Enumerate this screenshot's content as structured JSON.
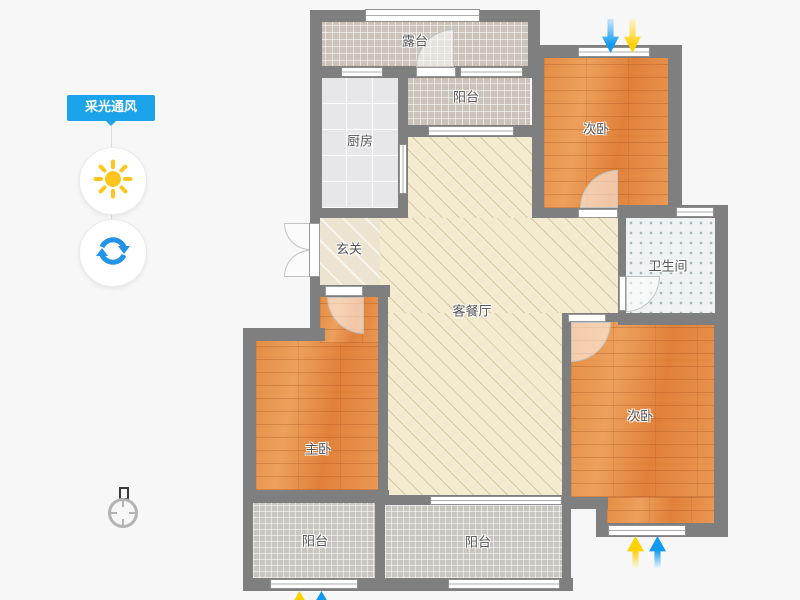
{
  "panel": {
    "badge_label": "采光通风",
    "accent_color": "#1aa3e8",
    "sun_button": {
      "icon": "sun-icon",
      "color": "#ffc41d"
    },
    "rotate_button": {
      "icon": "rotate-icon",
      "color": "#2293e6"
    }
  },
  "floorplan": {
    "wall_color": "#7f7f7f",
    "rooms": [
      {
        "id": "terrace",
        "label": "露台"
      },
      {
        "id": "balcony-top",
        "label": "阳台"
      },
      {
        "id": "kitchen",
        "label": "厨房"
      },
      {
        "id": "bedroom-top",
        "label": "次卧"
      },
      {
        "id": "foyer",
        "label": "玄关"
      },
      {
        "id": "bathroom",
        "label": "卫生间"
      },
      {
        "id": "living-dining",
        "label": "客餐厅"
      },
      {
        "id": "master-bedroom",
        "label": "主卧"
      },
      {
        "id": "bedroom-bottom",
        "label": "次卧"
      },
      {
        "id": "balcony-left",
        "label": "阳台"
      },
      {
        "id": "balcony-middle",
        "label": "阳台"
      }
    ],
    "indicators": {
      "top_window": [
        {
          "icon": "arrow-down-icon",
          "color": "#119bf0"
        },
        {
          "icon": "arrow-down-icon",
          "color": "#ffd200"
        }
      ],
      "bottom_right_window": [
        {
          "icon": "arrow-up-icon",
          "color": "#ffd200"
        },
        {
          "icon": "arrow-up-icon",
          "color": "#119bf0"
        }
      ],
      "bottom_left_window": [
        {
          "icon": "arrow-up-icon",
          "color": "#ffd200"
        },
        {
          "icon": "arrow-up-icon",
          "color": "#119bf0"
        }
      ]
    },
    "compass": {
      "icon": "compass-north-icon"
    }
  }
}
